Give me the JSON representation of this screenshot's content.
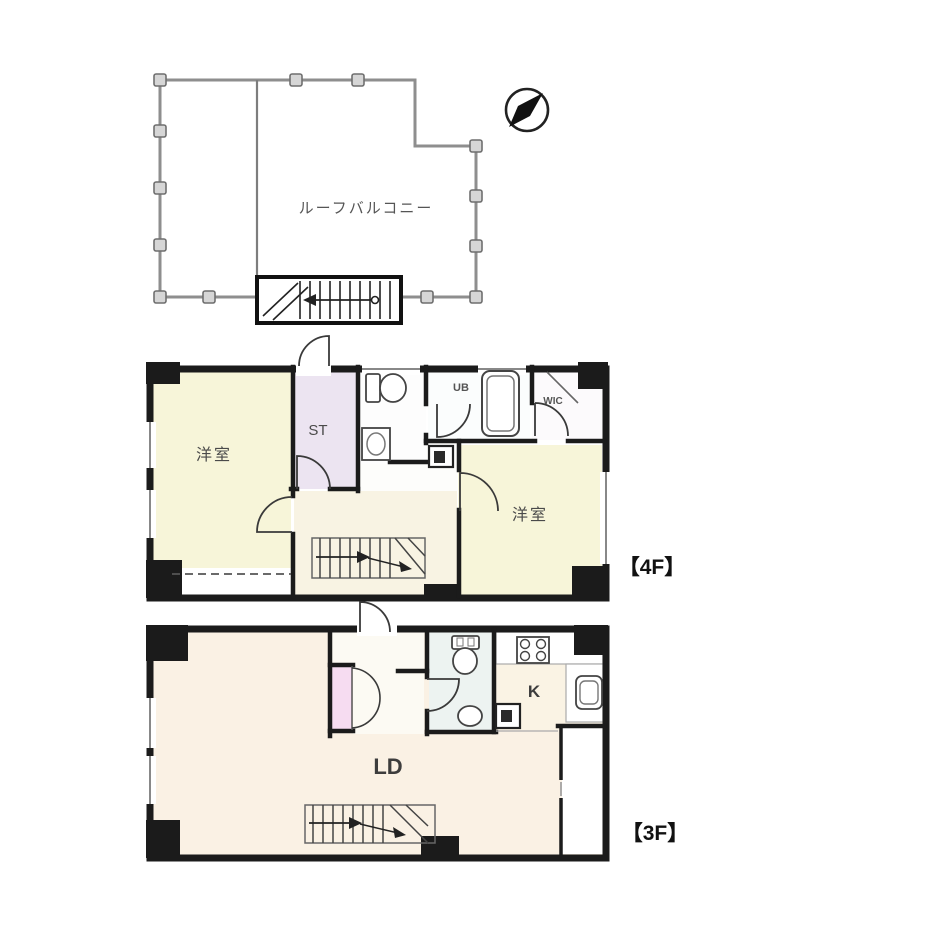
{
  "roof_plan": {
    "label": "ルーフバルコニー"
  },
  "floor_4f": {
    "tag": "【4F】",
    "rooms": {
      "left_bedroom": "洋室",
      "storage": "ST",
      "unit_bath": "UB",
      "walk_in_closet": "WIC",
      "right_bedroom": "洋室"
    }
  },
  "floor_3f": {
    "tag": "【3F】",
    "rooms": {
      "living_dining": "LD",
      "kitchen": "K"
    }
  },
  "colors": {
    "wall": "#1b1b1b",
    "bedroom_yellow": "#f7f5d9",
    "living_cream": "#faf1e4",
    "storage_lavender": "#ece4f1",
    "closet_pink": "#f6dcf1",
    "toilet_pale": "#edf3f1",
    "railing_gray": "#8e8e8e"
  }
}
